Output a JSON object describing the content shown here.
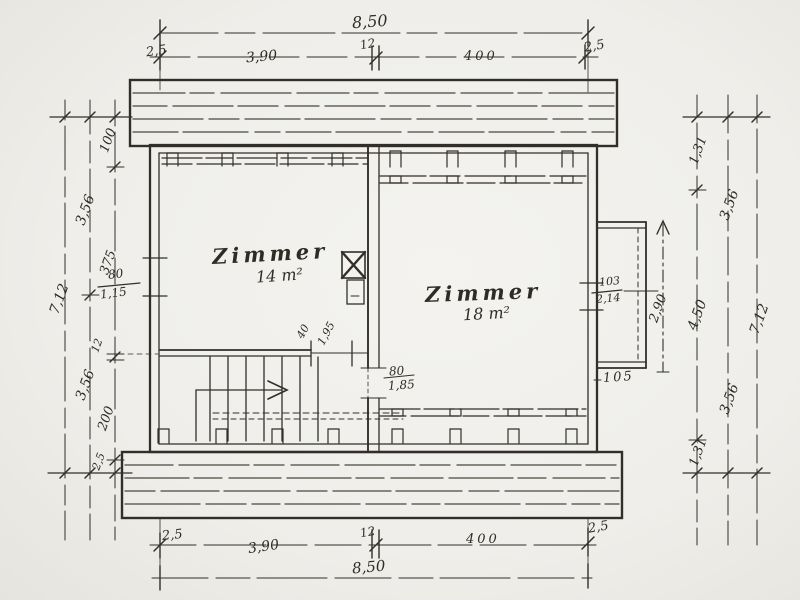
{
  "plan": {
    "paper_color": "#f2f1ec",
    "ink_color": "#322f2a",
    "rooms": [
      {
        "name": "Zimmer",
        "area": "14 m²"
      },
      {
        "name": "Zimmer",
        "area": "18 m²"
      }
    ],
    "dims_top": {
      "total": "8,50",
      "segments": [
        "2,5",
        "3,90",
        "12",
        "400",
        "2,5"
      ]
    },
    "dims_bottom": {
      "total": "8,50",
      "segments": [
        "2,5",
        "3,90",
        "12",
        "400",
        "2,5"
      ]
    },
    "dims_left": {
      "overall": "7,12",
      "halves": [
        "3,56",
        "3,56"
      ],
      "inner": [
        "100",
        "375",
        "12",
        "200",
        "2,5"
      ],
      "window": {
        "width": "80",
        "sill": "1,15"
      }
    },
    "dims_right": {
      "overall": "7,12",
      "halves": [
        "3,56",
        "3,56"
      ],
      "inner": [
        "1,31",
        "4,50",
        "1,31"
      ],
      "balcony": {
        "depth": "2,90",
        "width": "105"
      },
      "door": {
        "width": "103",
        "height": "2,14"
      }
    },
    "interior": {
      "door": {
        "width": "80",
        "height": "1,85"
      },
      "opening": {
        "width": "40",
        "height": "1,95"
      }
    }
  }
}
